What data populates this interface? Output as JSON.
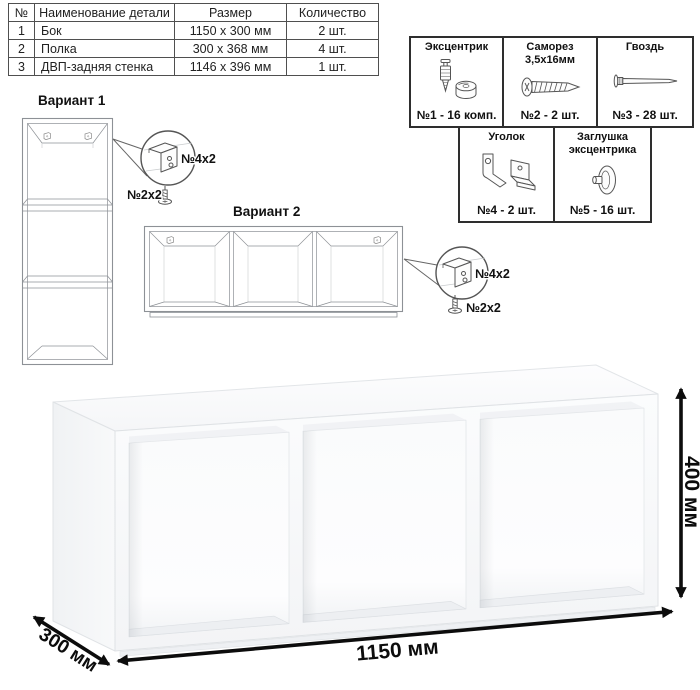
{
  "parts_table": {
    "headers": [
      "№",
      "Наименование детали",
      "Размер",
      "Количество"
    ],
    "rows": [
      {
        "num": "1",
        "name": "Бок",
        "size": "1150 x 300 мм",
        "qty": "2 шт."
      },
      {
        "num": "2",
        "name": "Полка",
        "size": "300 x 368 мм",
        "qty": "4 шт."
      },
      {
        "num": "3",
        "name": "ДВП-задняя стенка",
        "size": "1146 x 396 мм",
        "qty": "1 шт."
      }
    ]
  },
  "hardware": {
    "items": [
      {
        "title": "Эксцентрик",
        "count": "№1 - 16 комп.",
        "icon": "eccentric-cam-icon"
      },
      {
        "title": "Саморез 3,5х16мм",
        "count": "№2 - 2 шт.",
        "icon": "self-tapping-screw-icon"
      },
      {
        "title": "Гвоздь",
        "count": "№3 - 28 шт.",
        "icon": "nail-icon"
      },
      {
        "title": "Уголок",
        "count": "№4 - 2 шт.",
        "icon": "corner-bracket-icon"
      },
      {
        "title": "Заглушка эксцентрика",
        "count": "№5 - 16 шт.",
        "icon": "cam-cap-icon"
      }
    ]
  },
  "variants": [
    {
      "title": "Вариант 1",
      "bracket_label": "№4х2",
      "screw_label": "№2х2"
    },
    {
      "title": "Вариант 2",
      "bracket_label": "№4х2",
      "screw_label": "№2х2"
    }
  ],
  "dimensions": {
    "width": "1150 мм",
    "depth": "300 мм",
    "height": "400 мм"
  },
  "colors": {
    "line": "#8d9196",
    "text": "#111111",
    "dimension_arrows": "#0c0c0c",
    "background": "#ffffff"
  }
}
